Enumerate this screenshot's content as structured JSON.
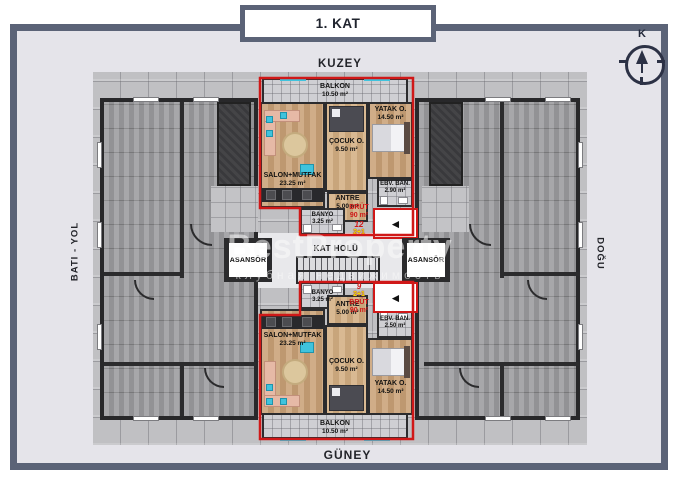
{
  "title": "1. KAT",
  "compass": {
    "north_letter": "K"
  },
  "directions": {
    "north": "KUZEY",
    "south": "GÜNEY",
    "west": "BATI - YOL",
    "east": "DOĞU"
  },
  "core": {
    "hall_label": "KAT HOLÜ",
    "elevator_left": "ASANSÖR",
    "elevator_right": "ASANSÖR"
  },
  "watermark": {
    "line1": "BestProperty",
    "line2": "клубная недвижимость"
  },
  "arrow_glyph": "◄",
  "units": {
    "top": {
      "number": "12",
      "type_label": "2+1",
      "brut_label": "BRÜT",
      "brut_area": "90 m²",
      "rooms": {
        "balkon": {
          "name": "BALKON",
          "area": "10.50 m²"
        },
        "salon": {
          "name": "SALON+MUTFAK",
          "area": "23.25 m²"
        },
        "cocuk": {
          "name": "ÇOCUK O.",
          "area": "9.50 m²"
        },
        "yatak": {
          "name": "YATAK O.",
          "area": "14.50 m²"
        },
        "antre": {
          "name": "ANTRE",
          "area": "5.00 m²"
        },
        "banyo": {
          "name": "BANYO",
          "area": "3.25 m²"
        },
        "ebeveyn": {
          "name": "EBV. BAN.",
          "area": "2.90 m²"
        }
      }
    },
    "bottom": {
      "number": "9",
      "type_label": "2+1",
      "brut_label": "BRÜT",
      "brut_area": "90 m²",
      "rooms": {
        "balkon": {
          "name": "BALKON",
          "area": "10.50 m²"
        },
        "salon": {
          "name": "SALON+MUTFAK",
          "area": "23.25 m²"
        },
        "cocuk": {
          "name": "ÇOCUK O.",
          "area": "9.50 m²"
        },
        "yatak": {
          "name": "YATAK O.",
          "area": "14.50 m²"
        },
        "antre": {
          "name": "ANTRE",
          "area": "5.00 m²"
        },
        "banyo": {
          "name": "BANYO",
          "area": "3.25 m²"
        },
        "ebeveyn": {
          "name": "EBV. BAN.",
          "area": "2.50 m²"
        }
      }
    }
  },
  "colors": {
    "accent_red": "#d01818",
    "accent_yellow": "#f2e200",
    "frame": "#5b6377"
  }
}
